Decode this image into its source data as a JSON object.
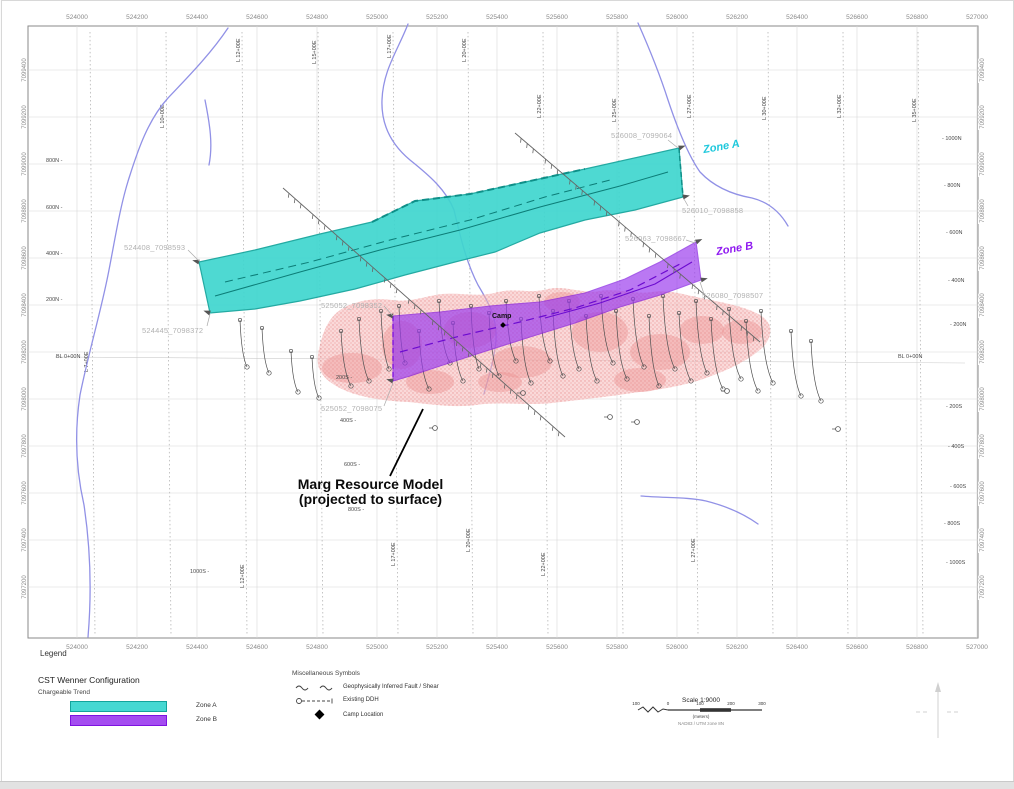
{
  "map": {
    "easting_labels": [
      "524000",
      "524200",
      "524400",
      "524600",
      "524800",
      "525000",
      "525200",
      "525400",
      "525600",
      "525800",
      "526000",
      "526200",
      "526400",
      "526600",
      "526800",
      "527000"
    ],
    "northing_labels": [
      "7099400",
      "7099200",
      "7099000",
      "7098800",
      "7098600",
      "7098400",
      "7098200",
      "7098000",
      "7097800",
      "7097600",
      "7097400",
      "7097200"
    ],
    "survey_lines": [
      {
        "label": "L 7+00E",
        "x": 90
      },
      {
        "label": "L 10+00E",
        "x": 166
      },
      {
        "label": "L 12+00E",
        "x": 242
      },
      {
        "label": "L 15+00E",
        "x": 318
      },
      {
        "label": "L 17+00E",
        "x": 393
      },
      {
        "label": "L 20+00E",
        "x": 468
      },
      {
        "label": "L 22+00E",
        "x": 543
      },
      {
        "label": "L 25+00E",
        "x": 618
      },
      {
        "label": "L 27+00E",
        "x": 693
      },
      {
        "label": "L 30+00E",
        "x": 768
      },
      {
        "label": "L 32+00E",
        "x": 843
      },
      {
        "label": "L 35+00E",
        "x": 918
      }
    ],
    "stations_left": [
      {
        "text": "800N -",
        "x": 46,
        "y": 158
      },
      {
        "text": "600N -",
        "x": 46,
        "y": 205
      },
      {
        "text": "400N -",
        "x": 46,
        "y": 251
      },
      {
        "text": "200N -",
        "x": 46,
        "y": 297
      },
      {
        "text": "BL 0+00N",
        "x": 56,
        "y": 354
      },
      {
        "text": "1000S -",
        "x": 190,
        "y": 569
      }
    ],
    "stations_mid": [
      {
        "text": "200S -",
        "x": 336,
        "y": 375
      },
      {
        "text": "400S -",
        "x": 340,
        "y": 418
      },
      {
        "text": "600S -",
        "x": 344,
        "y": 462
      },
      {
        "text": "800S -",
        "x": 348,
        "y": 507
      }
    ],
    "stations_right": [
      {
        "text": "- 1000N",
        "x": 942,
        "y": 136
      },
      {
        "text": "- 800N",
        "x": 944,
        "y": 183
      },
      {
        "text": "- 600N",
        "x": 946,
        "y": 230
      },
      {
        "text": "- 400N",
        "x": 948,
        "y": 278
      },
      {
        "text": "- 200N",
        "x": 950,
        "y": 322
      },
      {
        "text": "BL 0+00N",
        "x": 898,
        "y": 354
      },
      {
        "text": "- 200S",
        "x": 946,
        "y": 404
      },
      {
        "text": "- 400S",
        "x": 948,
        "y": 444
      },
      {
        "text": "- 600S",
        "x": 950,
        "y": 484
      },
      {
        "text": "- 800S",
        "x": 944,
        "y": 521
      },
      {
        "text": "- 1000S",
        "x": 946,
        "y": 560
      }
    ],
    "endpoint_labels": [
      {
        "text": "524408_7098593",
        "x": 124,
        "y": 243
      },
      {
        "text": "524445_7098372",
        "x": 142,
        "y": 326
      },
      {
        "text": "525052_7098352",
        "x": 321,
        "y": 301
      },
      {
        "text": "525052_7098075",
        "x": 321,
        "y": 404
      },
      {
        "text": "526008_7099064",
        "x": 611,
        "y": 131
      },
      {
        "text": "526010_7098858",
        "x": 682,
        "y": 206
      },
      {
        "text": "526063_7098667",
        "x": 625,
        "y": 234
      },
      {
        "text": "526080_7098507",
        "x": 702,
        "y": 291
      }
    ],
    "zone_a_label": "Zone A",
    "zone_b_label": "Zone B",
    "camp_label": "Camp",
    "annotation_line1": "Marg Resource Model",
    "annotation_line2": "(projected to surface)"
  },
  "legend": {
    "title": "Legend",
    "section1_title": "CST Wenner Configuration",
    "section1_subtitle": "Chargeable Trend",
    "items": [
      {
        "label": "Zone A",
        "color": "#45d8d2",
        "border": "#12a39b"
      },
      {
        "label": "Zone B",
        "color": "#a44df0",
        "border": "#7d12e0"
      }
    ],
    "misc_title": "Miscellaneous Symbols",
    "misc_items": [
      {
        "label": "Geophysically Inferred Fault / Shear"
      },
      {
        "label": "Existing DDH"
      },
      {
        "label": "Camp Location"
      }
    ],
    "scale_title": "Scale 1:9000",
    "scale_bar_labels": [
      "100",
      "0",
      "100",
      "200",
      "300"
    ],
    "scale_units": "(meters)",
    "scale_datum": "NAD83 / UTM zone 8N"
  },
  "colors": {
    "zone_a_fill": "#3fd6cf",
    "zone_a_stroke": "#12a39b",
    "zone_a_text": "#1fc8dc",
    "zone_b_fill": "#9a39ee",
    "zone_b_stroke": "#7d12e0",
    "zone_b_text": "#8e17f0",
    "resource_fill": "#f6b9b9",
    "resource_dots": "#e89090",
    "stream": "#9191e6",
    "grid": "#d8d8d8",
    "frame": "#8a8a8a",
    "endpoint_text": "#b2b2b2",
    "fault": "#666666",
    "drill": "#4d4d4d"
  }
}
